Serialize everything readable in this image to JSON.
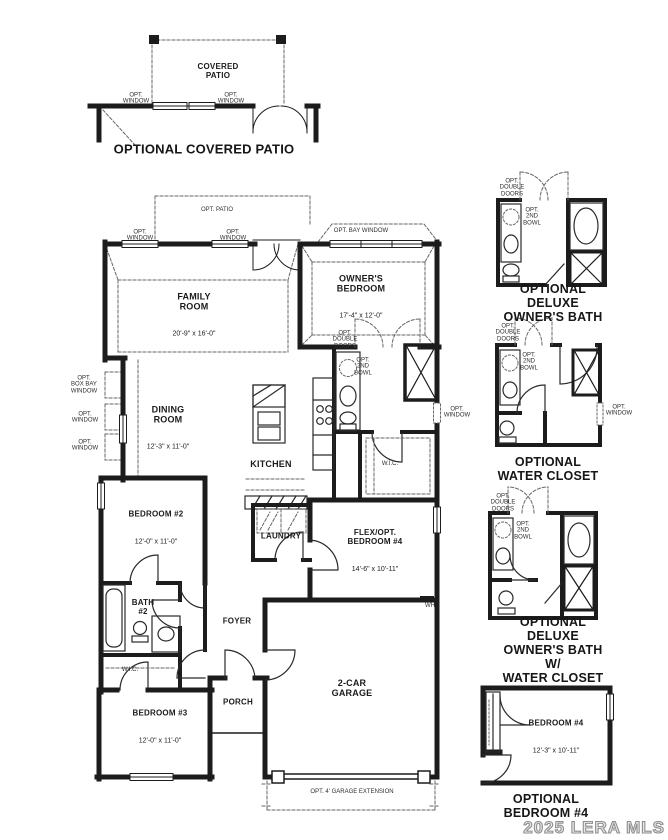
{
  "watermark": "2025 LERA MLS",
  "patio_inset": {
    "title": "OPTIONAL COVERED PATIO",
    "room_name": "COVERED\nPATIO",
    "opt_window_left": "OPT.\nWINDOW",
    "opt_window_right": "OPT.\nWINDOW"
  },
  "main_plan": {
    "opt_patio": "OPT. PATIO",
    "opt_window_top_left": "OPT.\nWINDOW",
    "opt_window_top_right": "OPT.\nWINDOW",
    "opt_bay_window": "OPT. BAY WINDOW",
    "family_room": {
      "name": "FAMILY\nROOM",
      "dims": "20'-9\" x 16'-0\""
    },
    "owners_bedroom": {
      "name": "OWNER'S\nBEDROOM",
      "dims": "17'-4\" x 12'-0\""
    },
    "opt_double_doors": "OPT.\nDOUBLE\nDOORS",
    "opt_2nd_bowl": "OPT.\n2ND\nBOWL",
    "opt_box_bay_window": "OPT.\nBOX BAY\nWINDOW",
    "opt_window_left_1": "OPT.\nWINDOW",
    "opt_window_left_2": "OPT.\nWINDOW",
    "dining_room": {
      "name": "DINING\nROOM",
      "dims": "12'-3\" x 11'-0\""
    },
    "kitchen": "KITCHEN",
    "wic_owners": "W.I.C.",
    "opt_window_right": "OPT.\nWINDOW",
    "bedroom2": {
      "name": "BEDROOM #2",
      "dims": "12'-0\" x 11'-0\""
    },
    "laundry": "LAUNDRY",
    "bath2": "BATH\n#2",
    "foyer": "FOYER",
    "flex_bedroom4": {
      "name": "FLEX/OPT.\nBEDROOM #4",
      "dims": "14'-6\" x 10'-11\""
    },
    "wic_bed3": "W.I.C.",
    "wh": "WH",
    "bedroom3": {
      "name": "BEDROOM #3",
      "dims": "12'-0\" x 11'-0\""
    },
    "porch": "PORCH",
    "garage": {
      "name": "2-CAR\nGARAGE"
    },
    "opt_garage_ext": "OPT. 4' GARAGE EXTENSION"
  },
  "deluxe_bath": {
    "title": "OPTIONAL DELUXE\nOWNER'S BATH",
    "opt_double_doors": "OPT.\nDOUBLE\nDOORS",
    "opt_2nd_bowl": "OPT.\n2ND\nBOWL"
  },
  "water_closet": {
    "title": "OPTIONAL\nWATER CLOSET",
    "opt_double_doors": "OPT.\nDOUBLE\nDOORS",
    "opt_2nd_bowl": "OPT.\n2ND\nBOWL",
    "opt_window": "OPT.\nWINDOW"
  },
  "deluxe_bath_wc": {
    "title": "OPTIONAL DELUXE\nOWNER'S BATH W/\nWATER CLOSET",
    "opt_double_doors": "OPT.\nDOUBLE\nDOORS",
    "opt_2nd_bowl": "OPT.\n2ND\nBOWL"
  },
  "opt_bedroom4": {
    "title": "OPTIONAL\nBEDROOM #4",
    "room": {
      "name": "BEDROOM #4",
      "dims": "12'-3\" x 10'-11\""
    }
  }
}
